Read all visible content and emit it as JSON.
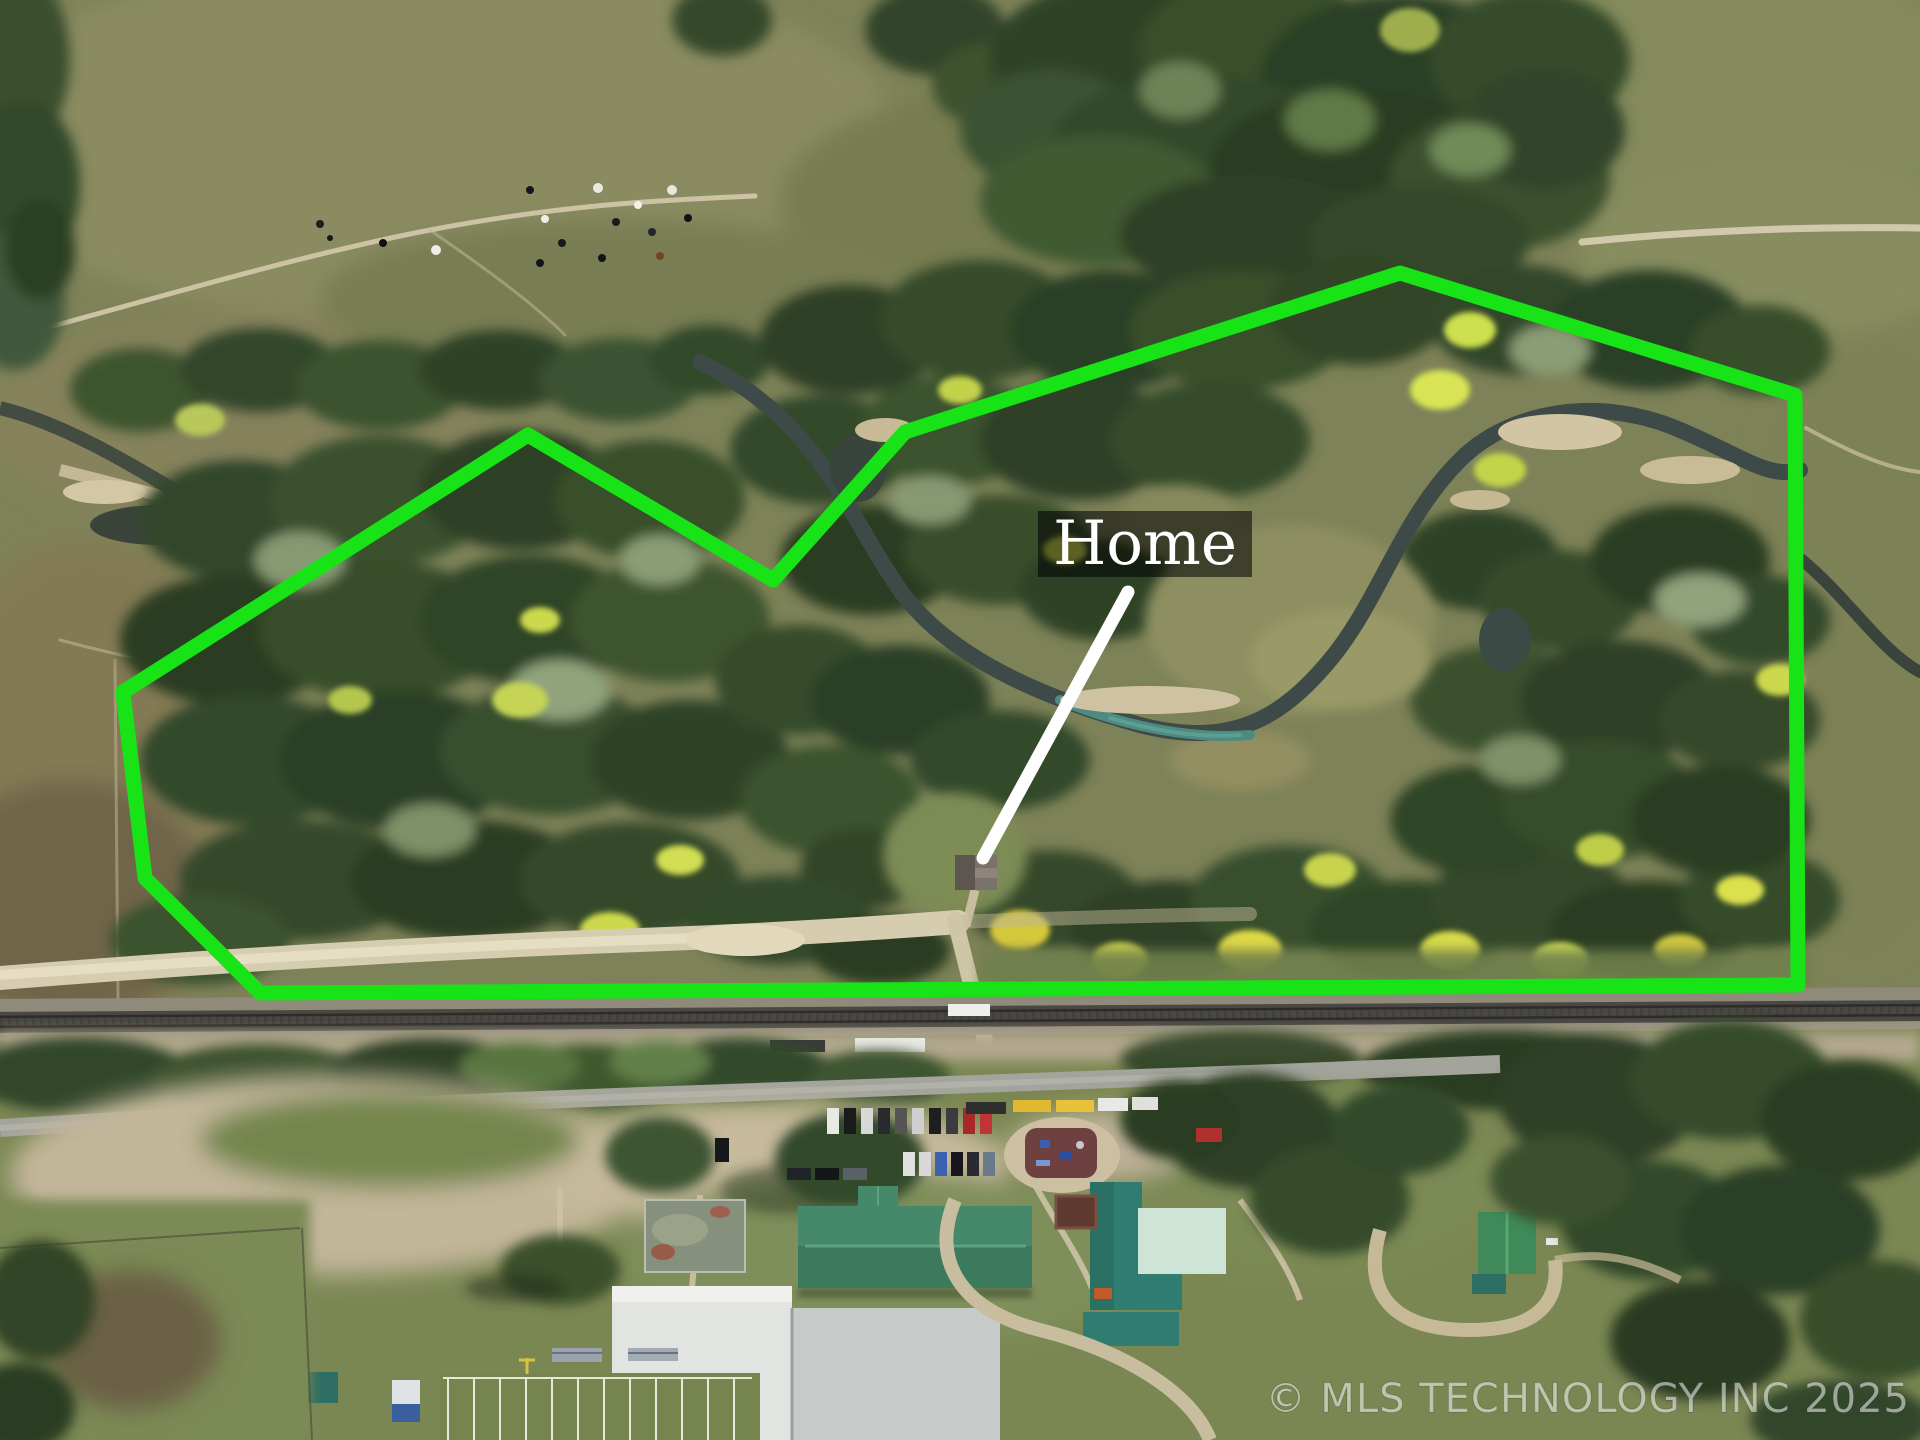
{
  "page": {
    "type": "aerial-property-listing-photo"
  },
  "annotation": {
    "home_label": "Home",
    "label_bg": "rgba(0,0,0,0.55)",
    "label_color": "#ffffff",
    "boundary_color": "#17e317",
    "boundary_points": "123,692 528,435 773,580 905,432 1400,273 1795,395 1798,985 260,993 145,878",
    "pointer_path": "M 1128 592 L 983 858",
    "pointer_color": "#ffffff"
  },
  "watermark": {
    "text": "© MLS TECHNOLOGY INC 2025",
    "color": "rgba(255,255,255,0.52)"
  },
  "scene": {
    "palette": {
      "pasture": "#7e8258",
      "forest_dark": "#2c3f25",
      "forest_mid": "#3a512e",
      "forest_pale": "#8a9d74",
      "autumn_yellow": "#d6dc4a",
      "creek_water": "#3e4a47",
      "creek_teal": "#4d8a80",
      "sand": "#d2c5a4",
      "dirt_road": "#d6ccb0",
      "railroad": "#4a4844",
      "paved_road": "#a3a49c",
      "school_roof_green": "#3f7a60",
      "school_roof_white": "#e2e4e1",
      "gym_roof_teal": "#2f7d70",
      "field_grass": "#76854e"
    },
    "features": [
      "north pasture with cattle",
      "wooded acreage",
      "winding creek with sandbars",
      "green property boundary outline",
      "home site",
      "dirt road",
      "railroad",
      "school campus with parking and buses",
      "football field"
    ]
  }
}
